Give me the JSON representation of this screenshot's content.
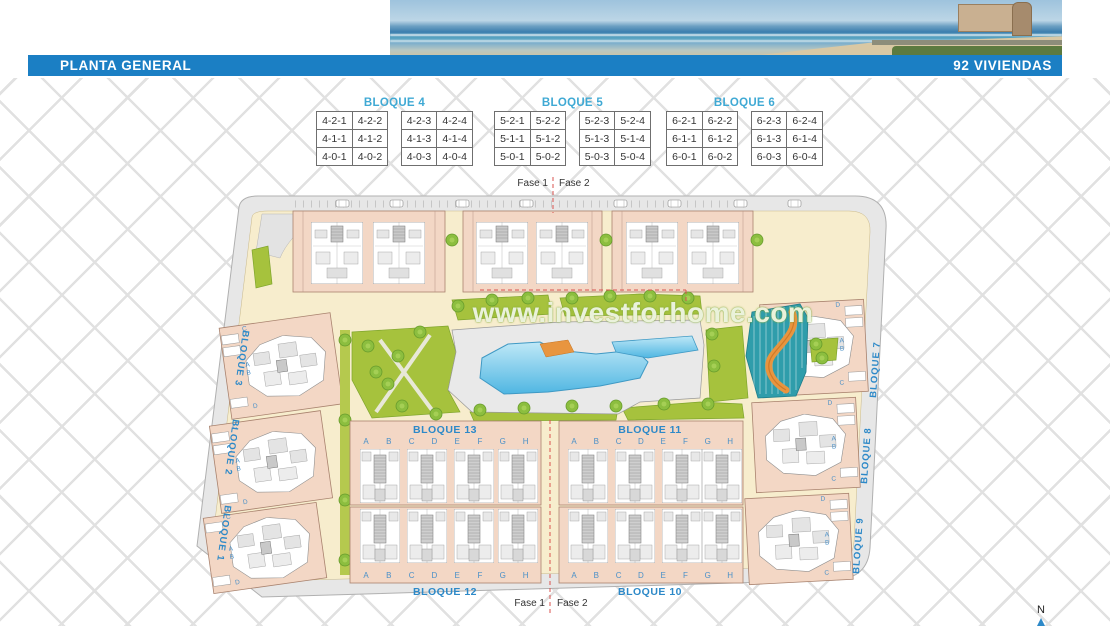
{
  "header": {
    "title": "PLANTA GENERAL",
    "units_count": "92 VIVIENDAS",
    "bar_color": "#1b7fc4"
  },
  "watermark": "www.investforhome.com",
  "tables": [
    {
      "title": "BLOQUE 4",
      "rows": [
        [
          "4-2-1",
          "4-2-2",
          "4-2-3",
          "4-2-4"
        ],
        [
          "4-1-1",
          "4-1-2",
          "4-1-3",
          "4-1-4"
        ],
        [
          "4-0-1",
          "4-0-2",
          "4-0-3",
          "4-0-4"
        ]
      ]
    },
    {
      "title": "BLOQUE 5",
      "rows": [
        [
          "5-2-1",
          "5-2-2",
          "5-2-3",
          "5-2-4"
        ],
        [
          "5-1-1",
          "5-1-2",
          "5-1-3",
          "5-1-4"
        ],
        [
          "5-0-1",
          "5-0-2",
          "5-0-3",
          "5-0-4"
        ]
      ]
    },
    {
      "title": "BLOQUE 6",
      "rows": [
        [
          "6-2-1",
          "6-2-2",
          "6-2-3",
          "6-2-4"
        ],
        [
          "6-1-1",
          "6-1-2",
          "6-1-3",
          "6-1-4"
        ],
        [
          "6-0-1",
          "6-0-2",
          "6-0-3",
          "6-0-4"
        ]
      ]
    }
  ],
  "plan": {
    "phase": {
      "fase1": "Fase 1",
      "fase2": "Fase 2"
    },
    "strip_blocks": {
      "top_left": "BLOQUE 13",
      "top_right": "BLOQUE 11",
      "bottom_left": "BLOQUE 12",
      "bottom_right": "BLOQUE 10"
    },
    "side_blocks_left": [
      "BLOQUE 3",
      "BLOQUE 2",
      "BLOQUE 1"
    ],
    "side_blocks_right": [
      "BLOQUE 7",
      "BLOQUE 8",
      "BLOQUE 9"
    ],
    "unit_letters": [
      "A",
      "B",
      "C",
      "D",
      "E",
      "F",
      "G",
      "H"
    ],
    "side_unit_letters": [
      "C",
      "A",
      "B",
      "D"
    ],
    "compass_north": "N",
    "colors": {
      "building_salmon": "#f3d7c5",
      "court_cream": "#f7edcd",
      "lawn_green": "#a6c23d",
      "pool_blue": "#5fc0e6",
      "splash_teal": "#2f9dab",
      "river_orange": "#e8953f",
      "road_gray": "#e7e7e7",
      "label_blue": "#2d89c8",
      "phase_line_red": "#d9534f",
      "table_title_blue": "#3fa9d4"
    }
  }
}
